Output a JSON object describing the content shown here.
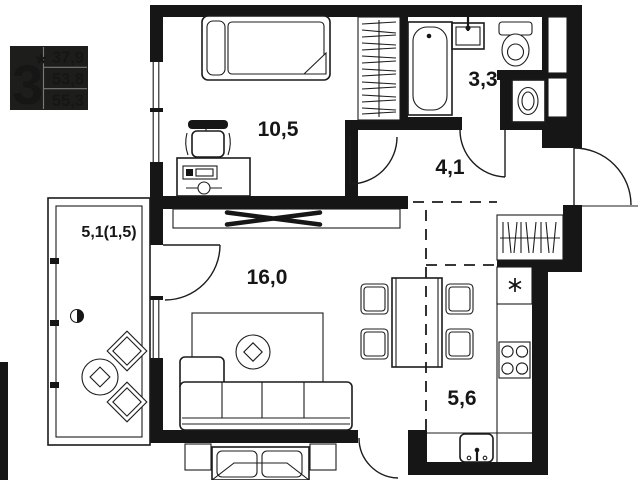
{
  "badge": {
    "rooms_count": "3",
    "asterisk": "*",
    "area_rows": [
      "37,9",
      "53,8",
      "55,3"
    ]
  },
  "rooms": {
    "bedroom": {
      "area_label": "10,5"
    },
    "bathroom": {
      "area_label": "3,3"
    },
    "hallway": {
      "area_label": "4,1"
    },
    "balcony": {
      "area_label": "5,1(1,5)"
    },
    "living_room": {
      "area_label": "16,0"
    },
    "kitchen": {
      "area_label": "5,6"
    }
  },
  "colors": {
    "walls": "#161616",
    "background": "#ffffff",
    "lines": "#1c1c1c",
    "badge_bg": "#1d1d1b",
    "badge_text": "#ffffff"
  }
}
